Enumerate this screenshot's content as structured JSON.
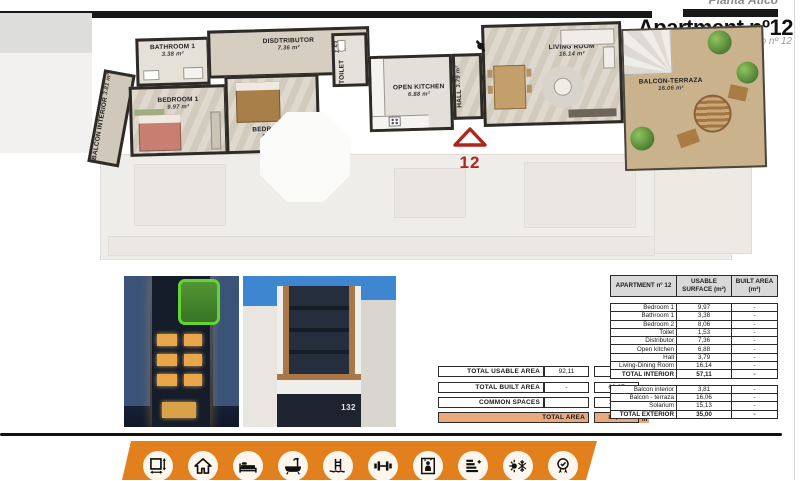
{
  "header": {
    "floor_label": "Planta Ático",
    "title": "Apartment nº12",
    "subtitle": "Apartamento nº 12"
  },
  "floor_plan": {
    "marker_number": "12",
    "rooms": [
      {
        "name": "BALCON INTERIOR",
        "area": "3.81 m²"
      },
      {
        "name": "BATHROOM 1",
        "area": "3.38 m²"
      },
      {
        "name": "BEDROOM 1",
        "area": "9.97 m²"
      },
      {
        "name": "DISDTRIBUTOR",
        "area": "7.36 m²"
      },
      {
        "name": "BEDROOM 2",
        "area": "8.06 m²"
      },
      {
        "name": "TOILET",
        "area": "1.53 m²"
      },
      {
        "name": "OPEN KITCHEN",
        "area": "6.88 m²"
      },
      {
        "name": "HALL",
        "area": "3.79 m²"
      },
      {
        "name": "LIVING ROOM",
        "area": "16.14 m²"
      },
      {
        "name": "BALCON-TERRAZA",
        "area": "16.06 m²"
      }
    ]
  },
  "photos": {
    "day": {
      "house_number": "132"
    }
  },
  "tables": {
    "summary": {
      "rows": [
        {
          "label": "TOTAL USABLE AREA",
          "usable": "92,11",
          "built": "-"
        },
        {
          "label": "TOTAL BUILT AREA",
          "usable": "-",
          "built": "69,67"
        },
        {
          "label": "COMMON SPACES",
          "usable": "",
          "built": "15,90"
        }
      ],
      "total": {
        "label": "TOTAL AREA",
        "value": "85,57",
        "unit": "m²"
      }
    },
    "detail": {
      "headers": [
        "APARTMENT nº 12",
        "USABLE SURFACE (m²)",
        "BUILT AREA (m²)"
      ],
      "interior_rows": [
        [
          "Bedroom 1",
          "9,97",
          "-"
        ],
        [
          "Bathroom 1",
          "3,38",
          "-"
        ],
        [
          "Bedroom 2",
          "8,06",
          "-"
        ],
        [
          "Toilet",
          "1,53",
          "-"
        ],
        [
          "Distributor",
          "7,36",
          "-"
        ],
        [
          "Open kitchen",
          "6,88",
          "-"
        ],
        [
          "Hall",
          "3,79",
          "-"
        ],
        [
          "Living-Dining Room",
          "16,14",
          "-"
        ],
        [
          "TOTAL INTERIOR",
          "57,11",
          "-"
        ]
      ],
      "exterior_rows": [
        [
          "Balcon interior",
          "3,81",
          "-"
        ],
        [
          "Balcon - terraza",
          "16,06",
          "-"
        ],
        [
          "Solarium",
          "15,13",
          "-"
        ],
        [
          "TOTAL EXTERIOR",
          "35,00",
          "-"
        ]
      ]
    }
  },
  "amenities": {
    "icons": [
      "dimensions-icon",
      "home-icon",
      "bed-icon",
      "bath-icon",
      "pool-icon",
      "gym-icon",
      "elevator-icon",
      "energy-rating-icon",
      "climate-icon",
      "quality-badge-icon"
    ]
  },
  "colors": {
    "accent_orange": "#e2801e",
    "total_area_fill": "#eaa97c",
    "marker_red": "#b3241c",
    "highlight_green": "#63d434",
    "table_header_gray": "#d9d9d9"
  }
}
